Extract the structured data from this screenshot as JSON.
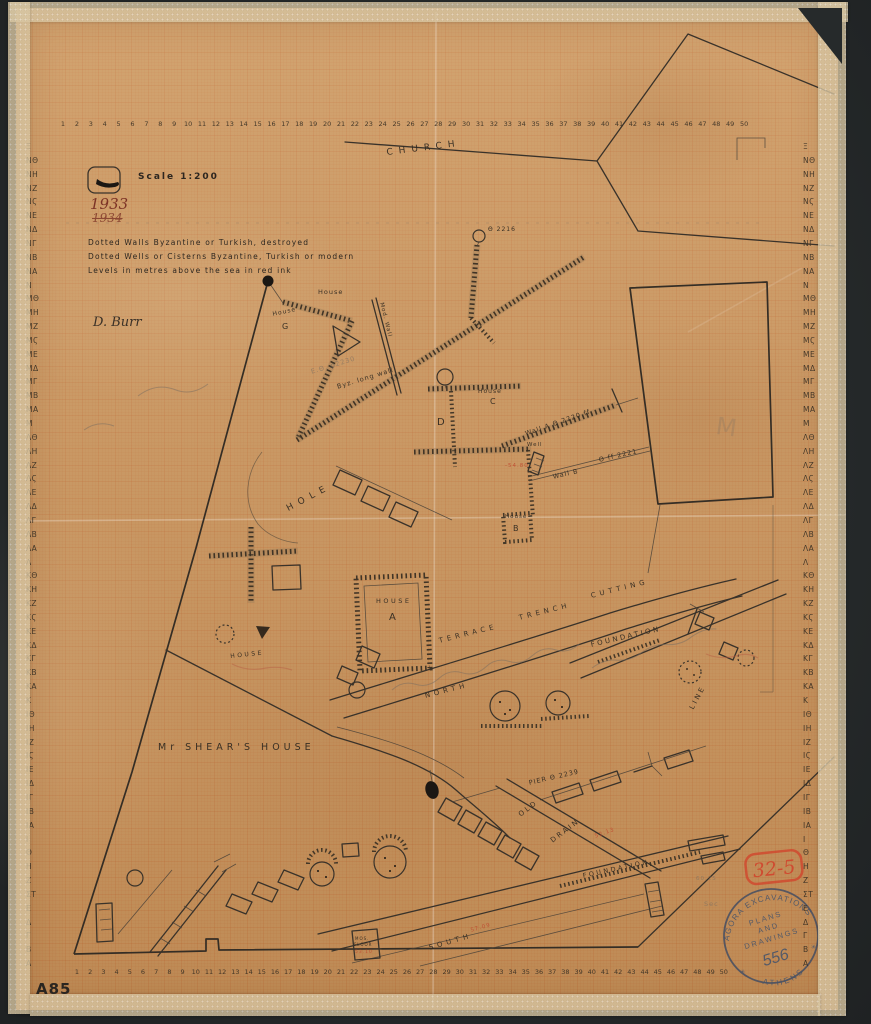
{
  "artifact": {
    "catalog_number": "A85",
    "scale_label": "Scale 1:200",
    "year": "1933",
    "year_struck": "1934",
    "signature": "D. Burr",
    "legend": [
      "Dotted Walls Byzantine or Turkish, destroyed",
      "Dotted Wells or Cisterns Byzantine, Turkish or modern",
      "Levels in metres above the sea in red ink"
    ]
  },
  "stamp": {
    "arc_top": "AGORA EXCAVATIONS",
    "arc_bottom": "ATHENS",
    "line1": "PLANS",
    "line2": "AND",
    "line3": "DRAWINGS",
    "number": "556",
    "star_glyph": "✳"
  },
  "red_stamp": "32-5",
  "rulers": {
    "columns": [
      "1",
      "2",
      "3",
      "4",
      "5",
      "6",
      "7",
      "8",
      "9",
      "10",
      "11",
      "12",
      "13",
      "14",
      "15",
      "16",
      "17",
      "18",
      "19",
      "20",
      "21",
      "22",
      "23",
      "24",
      "25",
      "26",
      "27",
      "28",
      "29",
      "30",
      "31",
      "32",
      "33",
      "34",
      "35",
      "36",
      "37",
      "38",
      "39",
      "40",
      "41",
      "42",
      "43",
      "44",
      "45",
      "46",
      "47",
      "48",
      "49",
      "50"
    ],
    "rows": [
      "Ξ",
      "ΝΘ",
      "ΝΗ",
      "ΝΖ",
      "ΝϚ",
      "ΝΕ",
      "ΝΔ",
      "ΝΓ",
      "ΝΒ",
      "ΝΑ",
      "Ν",
      "ΜΘ",
      "ΜΗ",
      "ΜΖ",
      "ΜϚ",
      "ΜΕ",
      "ΜΔ",
      "ΜΓ",
      "ΜΒ",
      "ΜΑ",
      "Μ",
      "ΛΘ",
      "ΛΗ",
      "ΛΖ",
      "ΛϚ",
      "ΛΕ",
      "ΛΔ",
      "ΛΓ",
      "ΛΒ",
      "ΛΑ",
      "Λ",
      "ΚΘ",
      "ΚΗ",
      "ΚΖ",
      "ΚϚ",
      "ΚΕ",
      "ΚΔ",
      "ΚΓ",
      "ΚΒ",
      "ΚΑ",
      "Κ",
      "ΙΘ",
      "ΙΗ",
      "ΙΖ",
      "ΙϚ",
      "ΙΕ",
      "ΙΔ",
      "ΙΓ",
      "ΙΒ",
      "ΙΑ",
      "Ι",
      "Θ",
      "Η",
      "Ζ",
      "ΣΤ",
      "Ε",
      "Δ",
      "Γ",
      "Β",
      "Α"
    ]
  },
  "map_labels": [
    {
      "t": "CHURCH",
      "x": 386,
      "y": 148,
      "r": -7,
      "s": 9,
      "c": "sp4"
    },
    {
      "t": "Θ 2216",
      "x": 488,
      "y": 226,
      "r": 0,
      "s": 6,
      "c": ""
    },
    {
      "t": "House",
      "x": 318,
      "y": 288,
      "r": 0,
      "s": 6.5,
      "c": ""
    },
    {
      "t": "House",
      "x": 272,
      "y": 311,
      "r": -12,
      "s": 6,
      "c": ""
    },
    {
      "t": "G",
      "x": 282,
      "y": 322,
      "r": 0,
      "s": 8,
      "c": ""
    },
    {
      "t": "Mod. Wall",
      "x": 384,
      "y": 302,
      "r": 76,
      "s": 5.5,
      "c": ""
    },
    {
      "t": "E.Θ. p2230",
      "x": 310,
      "y": 368,
      "r": -17,
      "s": 6.5,
      "c": "pencil"
    },
    {
      "t": "Byz. long wall",
      "x": 336,
      "y": 383,
      "r": -17,
      "s": 6.5,
      "c": ""
    },
    {
      "t": "House",
      "x": 478,
      "y": 388,
      "r": 0,
      "s": 6,
      "c": ""
    },
    {
      "t": "C",
      "x": 490,
      "y": 397,
      "r": 0,
      "s": 8,
      "c": ""
    },
    {
      "t": "D",
      "x": 437,
      "y": 417,
      "r": 0,
      "s": 10,
      "c": ""
    },
    {
      "t": "Wall A Θ 2220 ff",
      "x": 524,
      "y": 430,
      "r": -19,
      "s": 6.5,
      "c": ""
    },
    {
      "t": "Well",
      "x": 527,
      "y": 442,
      "r": 0,
      "s": 5.5,
      "c": ""
    },
    {
      "t": "-54.80",
      "x": 505,
      "y": 463,
      "r": 0,
      "s": 5.5,
      "c": "red"
    },
    {
      "t": "Wall B",
      "x": 552,
      "y": 473,
      "r": -13,
      "s": 6.5,
      "c": ""
    },
    {
      "t": "Θ ff 2221",
      "x": 598,
      "y": 456,
      "r": -13,
      "s": 6.5,
      "c": ""
    },
    {
      "t": "House",
      "x": 505,
      "y": 514,
      "r": 0,
      "s": 5.5,
      "c": ""
    },
    {
      "t": "B",
      "x": 513,
      "y": 524,
      "r": 0,
      "s": 8,
      "c": ""
    },
    {
      "t": "HOLE",
      "x": 285,
      "y": 505,
      "r": -28,
      "s": 9,
      "c": "sp4"
    },
    {
      "t": "HOUSE",
      "x": 230,
      "y": 653,
      "r": -6,
      "s": 6,
      "c": "sp2"
    },
    {
      "t": "HOUSE",
      "x": 376,
      "y": 597,
      "r": 0,
      "s": 6.5,
      "c": "sp2"
    },
    {
      "t": "A",
      "x": 389,
      "y": 612,
      "r": 0,
      "s": 10,
      "c": ""
    },
    {
      "t": "TERRACE",
      "x": 438,
      "y": 637,
      "r": -14,
      "s": 7,
      "c": "sp3"
    },
    {
      "t": "TRENCH",
      "x": 518,
      "y": 614,
      "r": -14,
      "s": 7,
      "c": "sp3"
    },
    {
      "t": "CUTTING",
      "x": 590,
      "y": 592,
      "r": -14,
      "s": 7,
      "c": "sp3"
    },
    {
      "t": "FOUNDATION",
      "x": 590,
      "y": 641,
      "r": -13,
      "s": 7,
      "c": "sp2"
    },
    {
      "t": "NORTH",
      "x": 424,
      "y": 692,
      "r": -14,
      "s": 7,
      "c": "sp3"
    },
    {
      "t": "LINE",
      "x": 688,
      "y": 707,
      "r": -62,
      "s": 7,
      "c": "sp2"
    },
    {
      "t": "Mr SHEAR'S HOUSE",
      "x": 158,
      "y": 742,
      "r": 0,
      "s": 9.5,
      "c": "sp3"
    },
    {
      "t": "PIER Θ 2239",
      "x": 528,
      "y": 779,
      "r": -13,
      "s": 6.5,
      "c": ""
    },
    {
      "t": "OLD",
      "x": 517,
      "y": 812,
      "r": -37,
      "s": 7,
      "c": "sp2"
    },
    {
      "t": "DRAIN",
      "x": 549,
      "y": 838,
      "r": -37,
      "s": 7,
      "c": "sp2"
    },
    {
      "t": "52.13",
      "x": 594,
      "y": 834,
      "r": -20,
      "s": 5.5,
      "c": "red"
    },
    {
      "t": "FOUNDATION",
      "x": 582,
      "y": 872,
      "r": -12,
      "s": 6.5,
      "c": "sp2"
    },
    {
      "t": "SOUTH",
      "x": 428,
      "y": 944,
      "r": -16,
      "s": 7,
      "c": "sp3"
    },
    {
      "t": "57.09",
      "x": 470,
      "y": 928,
      "r": -16,
      "s": 5.5,
      "c": "red"
    },
    {
      "t": "MOS.",
      "x": 355,
      "y": 936,
      "r": 0,
      "s": 4,
      "c": ""
    },
    {
      "t": "FLOOR",
      "x": 354,
      "y": 942,
      "r": 0,
      "s": 4,
      "c": ""
    },
    {
      "t": "53.10",
      "x": 355,
      "y": 950,
      "r": 0,
      "s": 4.5,
      "c": "red"
    },
    {
      "t": "60.25",
      "x": 696,
      "y": 876,
      "r": 0,
      "s": 5.5,
      "c": "pencil"
    },
    {
      "t": "Sec",
      "x": 704,
      "y": 900,
      "r": 0,
      "s": 6.5,
      "c": "pencil"
    },
    {
      "t": "M",
      "x": 718,
      "y": 412,
      "r": 8,
      "s": 24,
      "c": "pencil faint"
    }
  ]
}
